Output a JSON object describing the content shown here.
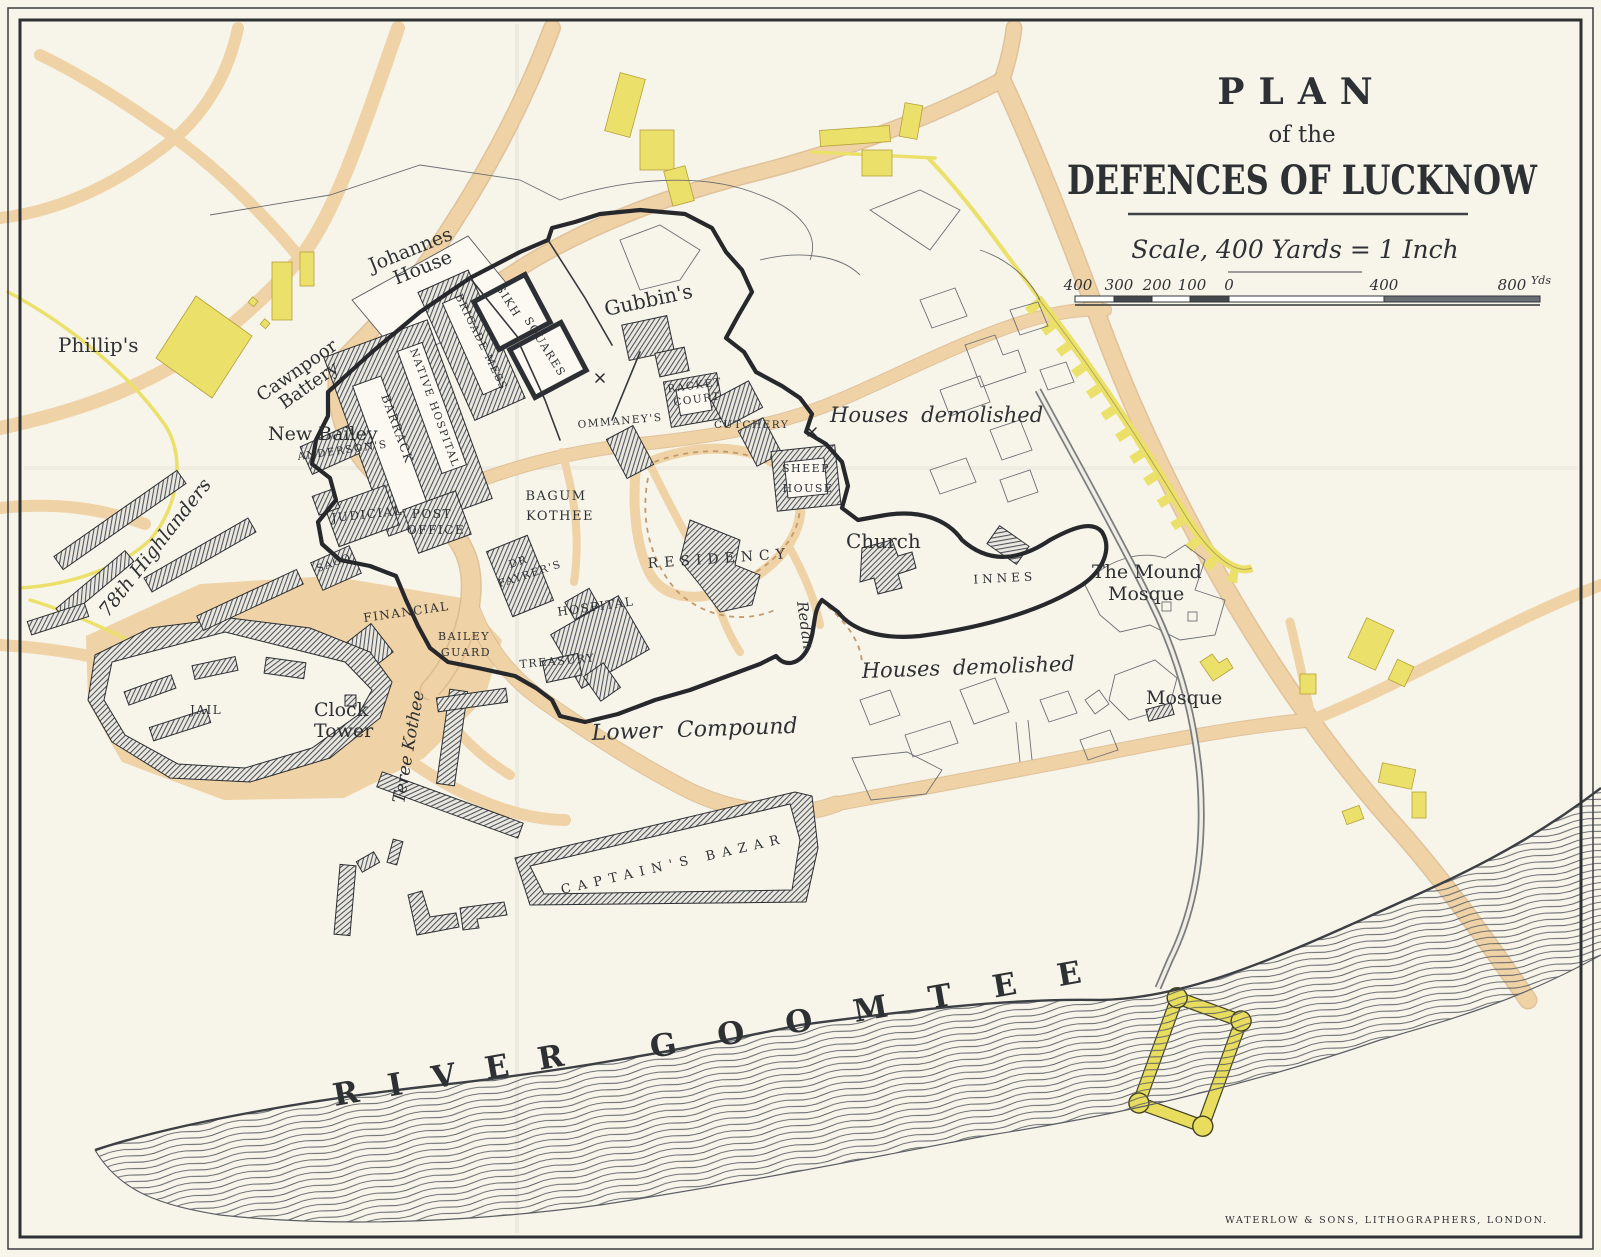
{
  "map": {
    "title": {
      "line1": "PLAN",
      "line2": "of the",
      "line3": "DEFENCES OF LUCKNOW"
    },
    "scale": {
      "caption": "Scale, 400 Yards = 1 Inch",
      "ticks": [
        "400",
        "300",
        "200",
        "100",
        "0",
        "400",
        "800"
      ],
      "unit": "Yds"
    },
    "imprint": "WATERLOW & SONS, LITHOGRAPHERS, LONDON.",
    "river": {
      "word1": "RIVER",
      "word2": "GOOMTEE"
    },
    "labels": {
      "phillips": "Phillip's",
      "johannes1": "Johannes",
      "johannes2": "House",
      "cawnpoor1": "Cawnpoor",
      "cawnpoor2": "Battery",
      "new_bailey": "New Bailey",
      "andersons": "ANDERSON'S",
      "barrack": "BARRACK",
      "native_hospital": "NATIVE HOSPITAL",
      "brigade_mess": "BRIGADE MESS",
      "sikh": "SIKH",
      "squares": "SQUARES",
      "gubbins": "Gubbin's",
      "racket1": "RACKET",
      "racket2": "COURT",
      "ommaneys": "OMMANEY'S",
      "cutchery": "CUTCHERY",
      "sheep1": "SHEEP",
      "sheep2": "HOUSE",
      "bagum1": "BAGUM",
      "bagum2": "KOTHEE",
      "judicial": "JUDICIAL",
      "post1": "POST",
      "post2": "OFFICE",
      "sago": "SAGO",
      "fayrer1": "DR",
      "fayrer2": "FAYRER'S",
      "residency": "RESIDENCY",
      "church": "Church",
      "innes": "INNES",
      "mound1": "The Mound",
      "mound2": "Mosque",
      "houses_demolished_n": "Houses demolished",
      "houses_demolished_s": "Houses demolished",
      "mosque": "Mosque",
      "redan": "Redan",
      "financial": "FINANCIAL",
      "bailey1": "BAILEY",
      "bailey2": "GUARD",
      "hospital": "HOSPITAL",
      "treasury": "TREASURY",
      "lower_compound": "Lower Compound",
      "captains_bazar": "CAPTAIN'S  BAZAR",
      "jail": "JAIL",
      "clock1": "Clock",
      "clock2": "Tower",
      "highlanders": "78th Highlanders",
      "teree_kothee": "Teree Kothee"
    },
    "colors": {
      "paper": "#f7f4ea",
      "road": "#efd2a5",
      "road_edge": "#d9b587",
      "yellow": "#ebe069",
      "ink": "#2e3134",
      "water_line": "#5c6065",
      "building_hatch": "#4d525a"
    }
  }
}
